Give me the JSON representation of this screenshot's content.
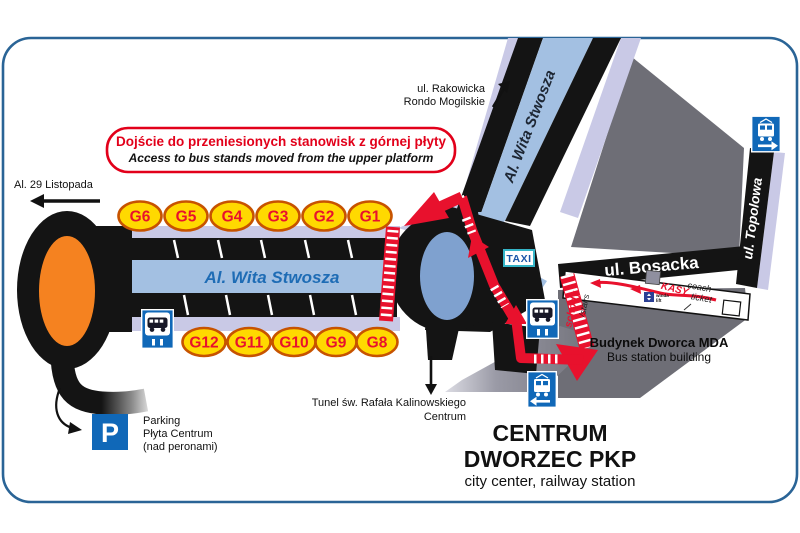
{
  "map": {
    "title_box": {
      "pl": "Dojście do przeniesionych stanowisk z górnej płyty",
      "en": "Access to bus stands moved from the upper platform"
    },
    "streets": {
      "al_29_listopada": "Al. 29 Listopada",
      "rakowicka": "ul. Rakowicka",
      "rondo_mogilskie": "Rondo Mogilskie",
      "wita_stwosza_upper": "Al. Wita Stwosza",
      "wita_stwosza": "Al. Wita Stwosza",
      "bosacka": "ul. Bosacka",
      "topolowa": "ul. Topolowa"
    },
    "signs": {
      "taxi": "TAXI",
      "parking_letter": "P"
    },
    "station": {
      "kasy": "KASY",
      "coach": "coach",
      "ticket": "ticket",
      "winda": "winda",
      "lift": "lift",
      "schody": "schody",
      "stairs": "/stairs",
      "building_pl": "Budynek Dworca MDA",
      "building_en": "Bus station building"
    },
    "destinations": {
      "tunel_l1": "Tunel św. Rafała Kalinowskiego",
      "tunel_l2": "Centrum",
      "centrum_l1": "CENTRUM",
      "centrum_l2": "DWORZEC PKP",
      "centrum_l3": "city center, railway station",
      "parking_l1": "Parking",
      "parking_l2": "Płyta Centrum",
      "parking_l3": "(nad peronami)"
    },
    "stands_top": [
      "G6",
      "G5",
      "G4",
      "G3",
      "G2",
      "G1"
    ],
    "stands_bottom": [
      "G12",
      "G11",
      "G10",
      "G9",
      "G8"
    ],
    "colors": {
      "route_red": "#e8112d",
      "title_red": "#e2001a",
      "stand_fill": "#ffd900",
      "stand_border": "#c75300",
      "road_blue": "#a3c0e2",
      "roundabout_blue": "#7fa1cf",
      "sidewalk_lavender": "#c9c9e6",
      "block_gray": "#6e6e76",
      "sign_blue": "#1068b8",
      "roundabout_orange": "#f58220",
      "street_text_blue": "#1e6cb5",
      "frame_blue": "#2a6496",
      "taxi_border": "#35b5c8"
    }
  }
}
